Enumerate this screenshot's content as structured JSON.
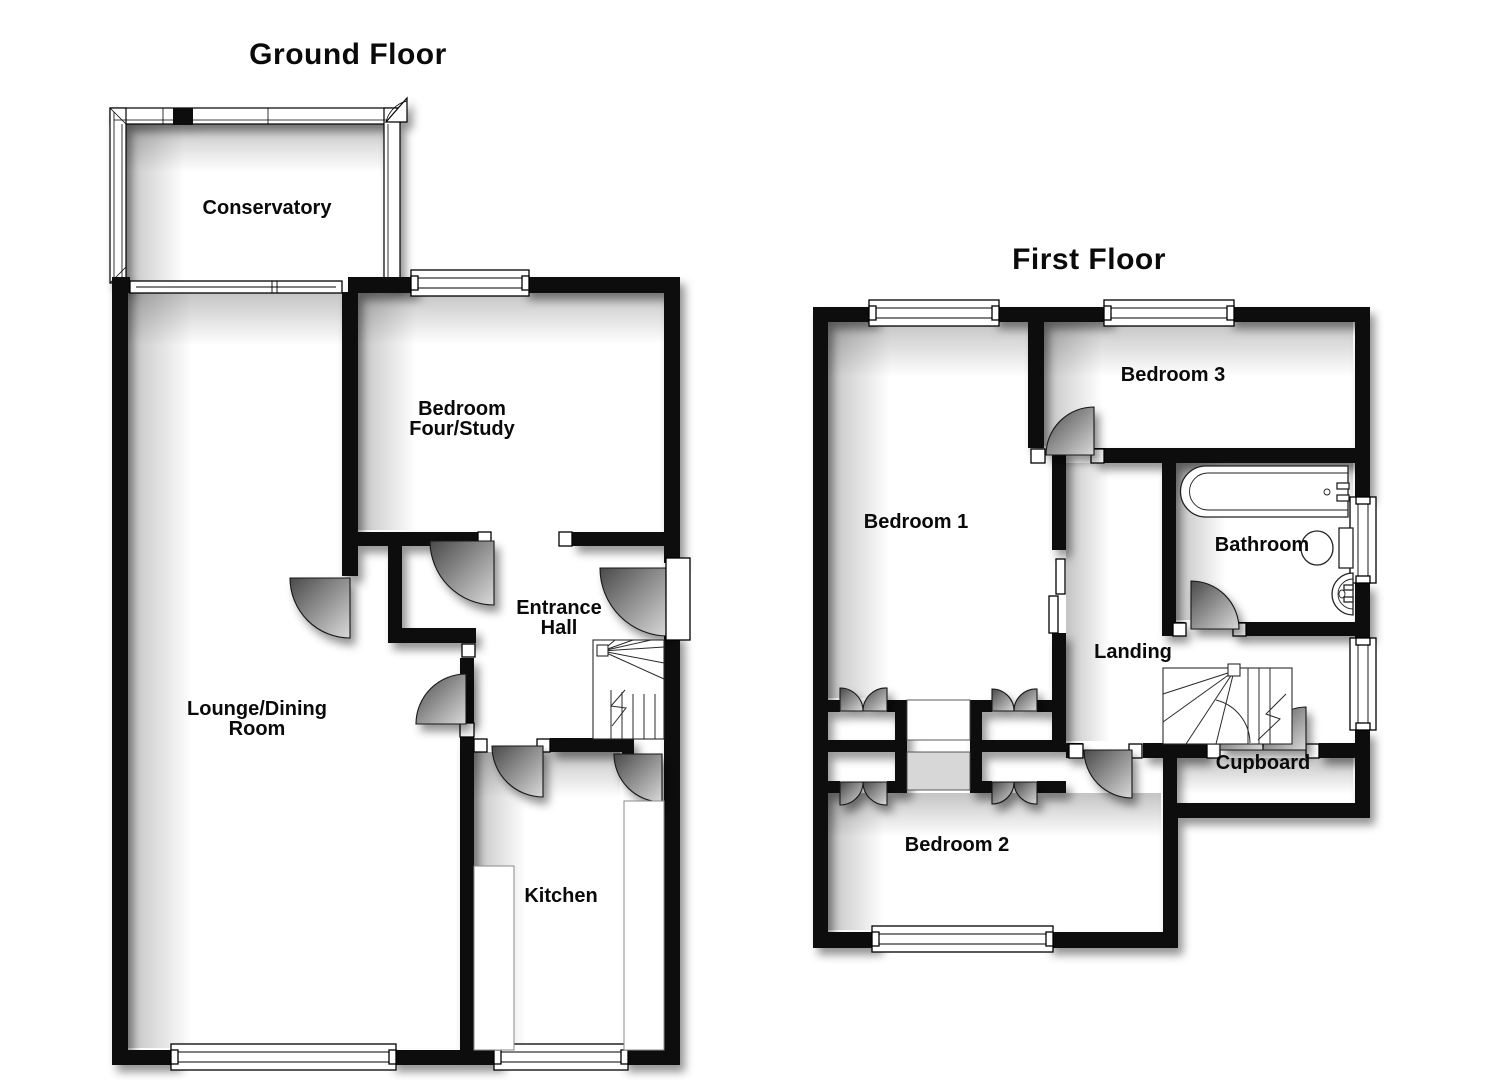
{
  "page": {
    "background_color": "#ffffff",
    "wall_color": "#0d0d0d",
    "text_color": "#0a0a0a"
  },
  "floors": [
    {
      "title": "Ground Floor",
      "rooms": [
        {
          "label": "Conservatory"
        },
        {
          "label": "Bedroom\nFour/Study"
        },
        {
          "label": "Entrance\nHall"
        },
        {
          "label": "Lounge/Dining\nRoom"
        },
        {
          "label": "Kitchen"
        }
      ],
      "fixtures": [
        "staircase",
        "front-door",
        "patio-doors",
        "conservatory-door",
        "kitchen-counters"
      ]
    },
    {
      "title": "First Floor",
      "rooms": [
        {
          "label": "Bedroom 1"
        },
        {
          "label": "Bedroom 3"
        },
        {
          "label": "Bathroom"
        },
        {
          "label": "Landing"
        },
        {
          "label": "Cupboard"
        },
        {
          "label": "Bedroom 2"
        }
      ],
      "fixtures": [
        "staircase",
        "bathtub",
        "toilet",
        "sink",
        "wardrobes",
        "bifold-doors"
      ]
    }
  ]
}
